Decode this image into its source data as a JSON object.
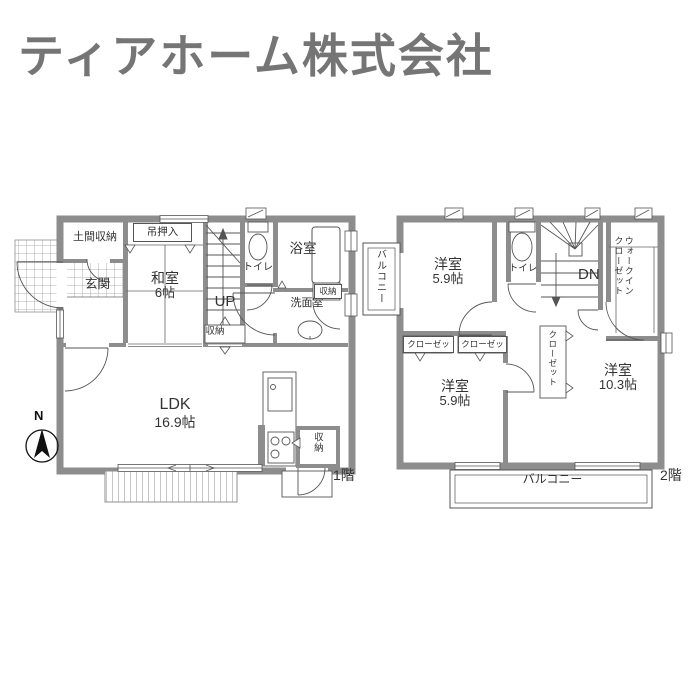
{
  "title": "ティアホーム株式会社",
  "compass": {
    "north": "N"
  },
  "colors": {
    "wall": "#8d8d8d",
    "line": "#555555",
    "title": "#757575"
  },
  "f1": {
    "floor": "1階",
    "doma": "土間収納",
    "genkan": "玄関",
    "tsuri_oshiire": "吊押入",
    "washitsu": "和室",
    "washitsu_size": "6帖",
    "up": "UP",
    "toilet": "トイレ",
    "bath": "浴室",
    "washroom": "洗面室",
    "storage_a": "収納",
    "storage_b": "収納",
    "storage_c": "収納",
    "ldk": "LDK",
    "ldk_size": "16.9帖"
  },
  "f2": {
    "floor": "2階",
    "balcony_left": "バルコニー",
    "balcony_bottom": "バルコニー",
    "bedroom1": "洋室",
    "bedroom1_size": "5.9帖",
    "toilet": "トイレ",
    "dn": "DN",
    "wic_line1": "ウォークイン",
    "wic_line2": "クローゼット",
    "closet_a": "クローゼット",
    "closet_b": "クローゼット",
    "closet_c": "クローゼット",
    "bedroom2": "洋室",
    "bedroom2_size": "5.9帖",
    "bedroom3": "洋室",
    "bedroom3_size": "10.3帖"
  }
}
